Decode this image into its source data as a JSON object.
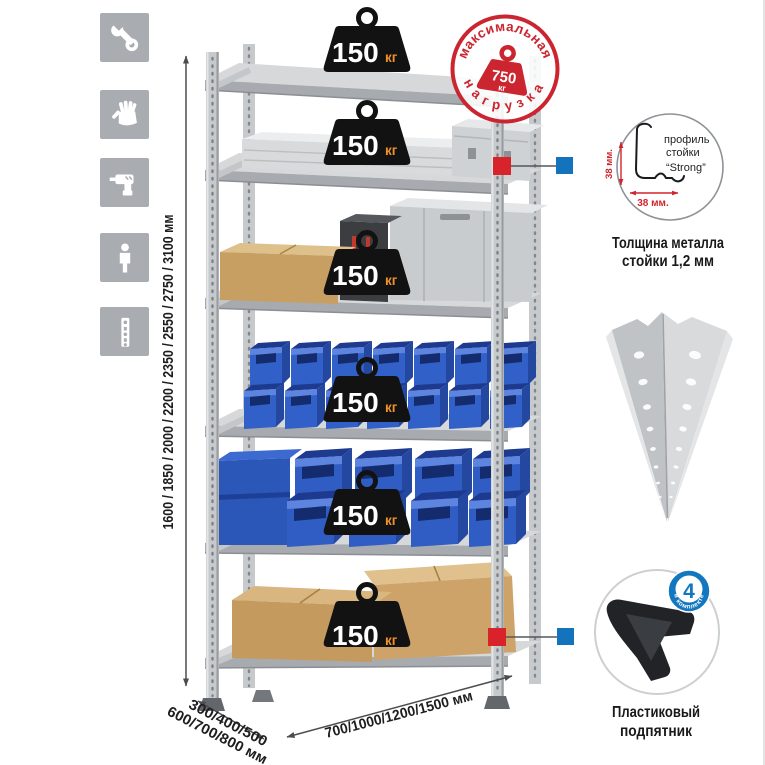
{
  "sidebar": {
    "icons": [
      "wrench",
      "gloves",
      "drill",
      "person",
      "post-profile"
    ]
  },
  "dimensions": {
    "height": "1600 / 1850 / 2000 / 2200 / 2350 / 2550 / 2750 / 3100 мм",
    "depth_line1": "300/400/500",
    "depth_line2": "600/700/800 мм",
    "width": "700/1000/1200/1500 мм"
  },
  "stamp": {
    "top": "максимальная",
    "bottom": "нагрузка",
    "value": "750",
    "unit": "кг"
  },
  "weights": [
    {
      "value": "150",
      "unit": "кг"
    },
    {
      "value": "150",
      "unit": "кг"
    },
    {
      "value": "150",
      "unit": "кг"
    },
    {
      "value": "150",
      "unit": "кг"
    },
    {
      "value": "150",
      "unit": "кг"
    },
    {
      "value": "150",
      "unit": "кг"
    }
  ],
  "profile_detail": {
    "label_line1": "профиль",
    "label_line2": "стойки",
    "label_line3": "“Strong”",
    "dim_v": "38 мм.",
    "dim_h": "38 мм.",
    "caption1": "Толщина металла",
    "caption2": "стойки 1,2 мм"
  },
  "foot_detail": {
    "badge": "4",
    "badge_arc": "в комплекте",
    "caption1": "Пластиковый",
    "caption2": "подпятник"
  },
  "colors": {
    "accent_red": "#d8232a",
    "accent_blue": "#1373bd",
    "stamp_red": "#cb2630",
    "bin_blue": "#3160c8",
    "metal_gray": "#c7cacd",
    "weight_unit_orange": "#f0922b",
    "icon_square_gray": "#a9adb2"
  }
}
